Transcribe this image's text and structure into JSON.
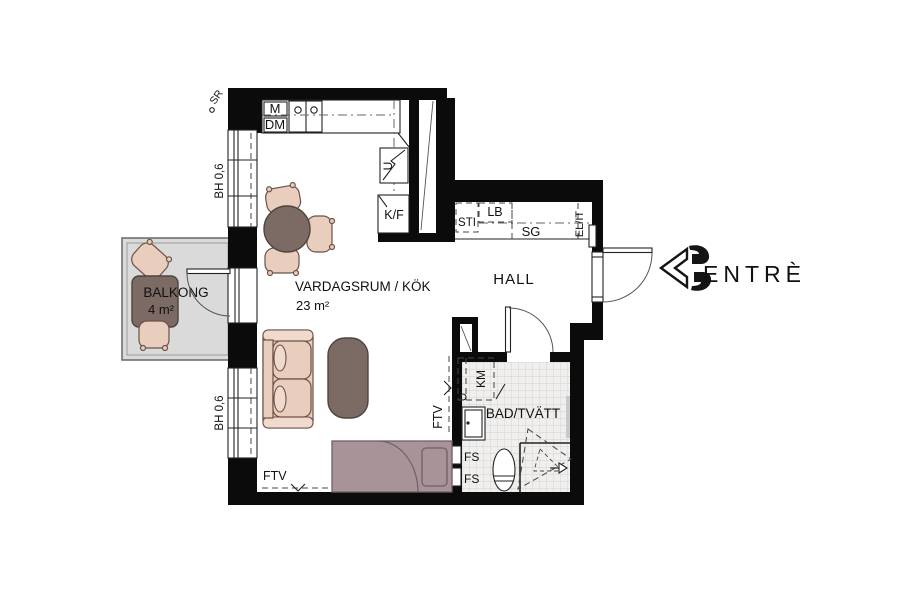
{
  "plan": {
    "rooms": {
      "balcony": {
        "name": "BALKONG",
        "area": "4 m²"
      },
      "living": {
        "name": "VARDAGSRUM / KÖK",
        "area": "23 m²"
      },
      "hall": {
        "name": "HALL"
      },
      "bath": {
        "name": "BAD/TVÄTT"
      }
    },
    "kitchen": {
      "microwave": "M",
      "dishwasher": "DM",
      "oven": "U",
      "fridge_freezer": "K/F"
    },
    "hall_storage": {
      "sti": "STI",
      "lb": "LB",
      "sg": "SG",
      "el_it": "EL/IT"
    },
    "bath_fixtures": {
      "washing_machine": "KM",
      "fs_upper": "FS",
      "fs_lower": "FS"
    },
    "annotations": {
      "sr": "SR",
      "ftv_floor": "FTV",
      "ftv_wall": "FTV"
    },
    "windows": {
      "bh_upper": "BH 0,6",
      "bh_lower": "BH 0,6"
    },
    "entrance": {
      "label": "ENTRÈ"
    }
  },
  "colors": {
    "wall": "#0b0b0b",
    "furniture_light": "#e9cdbd",
    "furniture_dark": "#7b6b64",
    "bed": "#a89399",
    "balcony_floor": "#dadada",
    "tile_floor": "#f0efee"
  }
}
